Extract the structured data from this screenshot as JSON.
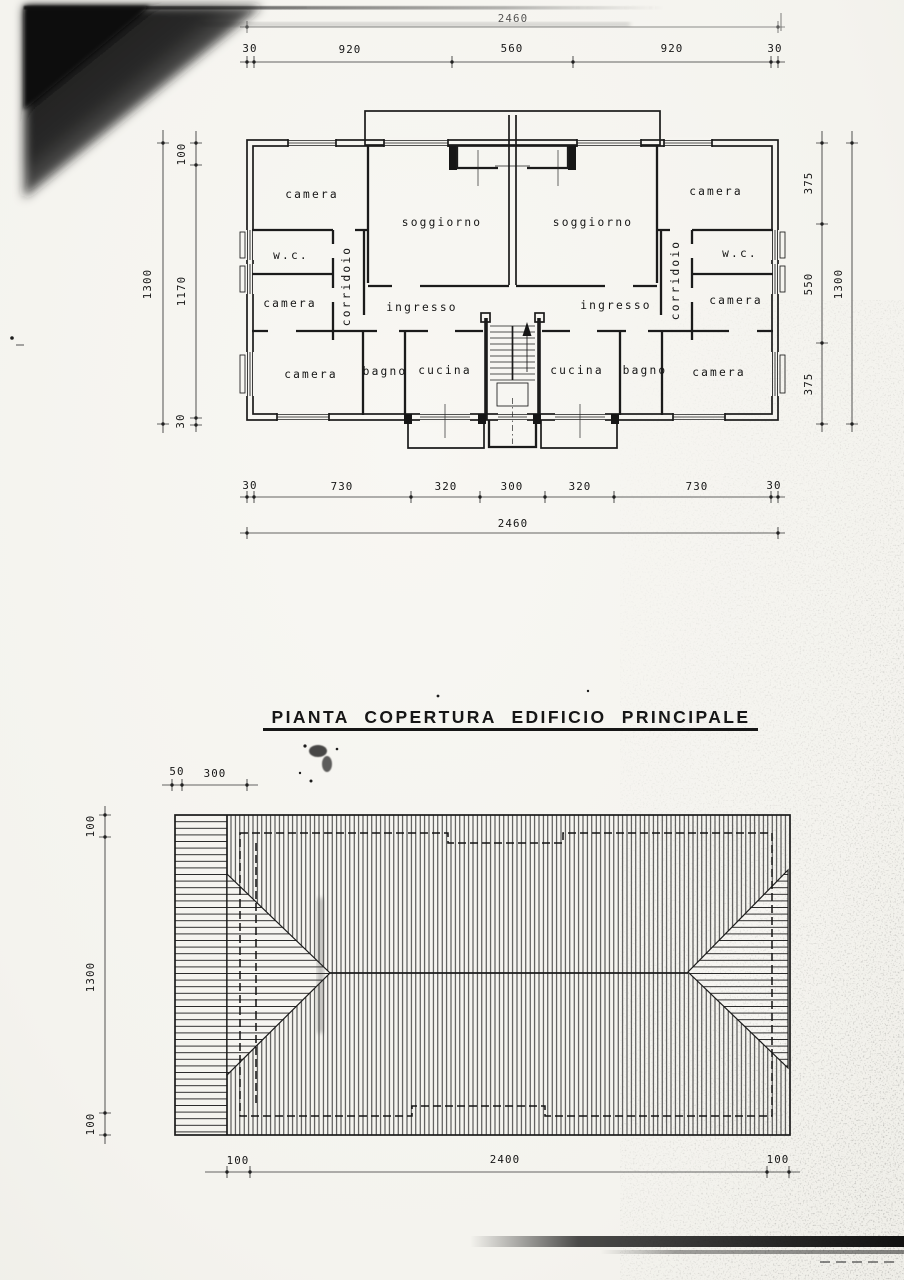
{
  "floor_plan": {
    "dim_total_top": "2460",
    "dim_top": [
      "30",
      "920",
      "560",
      "920",
      "30"
    ],
    "dim_left_outer": "1300",
    "dim_left_inner": [
      "100",
      "1170",
      "30"
    ],
    "dim_right_inner": [
      "375",
      "550",
      "375"
    ],
    "dim_right_outer": "1300",
    "dim_bottom": [
      "30",
      "730",
      "320",
      "300",
      "320",
      "730",
      "30"
    ],
    "dim_total_bottom": "2460",
    "rooms": {
      "camera_top_left": "camera",
      "soggiorno_left": "soggiorno",
      "soggiorno_right": "soggiorno",
      "camera_top_right": "camera",
      "wc_left": "w.c.",
      "wc_right": "w.c.",
      "camera_mid_left": "camera",
      "camera_mid_right": "camera",
      "corridoio_left": "corridoio",
      "corridoio_right": "corridoio",
      "ingresso_left": "ingresso",
      "ingresso_right": "ingresso",
      "camera_bottom_left": "camera",
      "bagno_left": "bagno",
      "cucina_left": "cucina",
      "cucina_right": "cucina",
      "bagno_right": "bagno",
      "camera_bottom_right": "camera"
    }
  },
  "roof_plan": {
    "title": "PIANTA COPERTURA EDIFICIO PRINCIPALE",
    "dim_top": [
      "50",
      "300"
    ],
    "dim_left": [
      "100",
      "1300",
      "100"
    ],
    "dim_bottom": [
      "100",
      "2400",
      "100"
    ]
  },
  "colors": {
    "paper": "#f6f5f1",
    "ink": "#1b1b1b"
  }
}
